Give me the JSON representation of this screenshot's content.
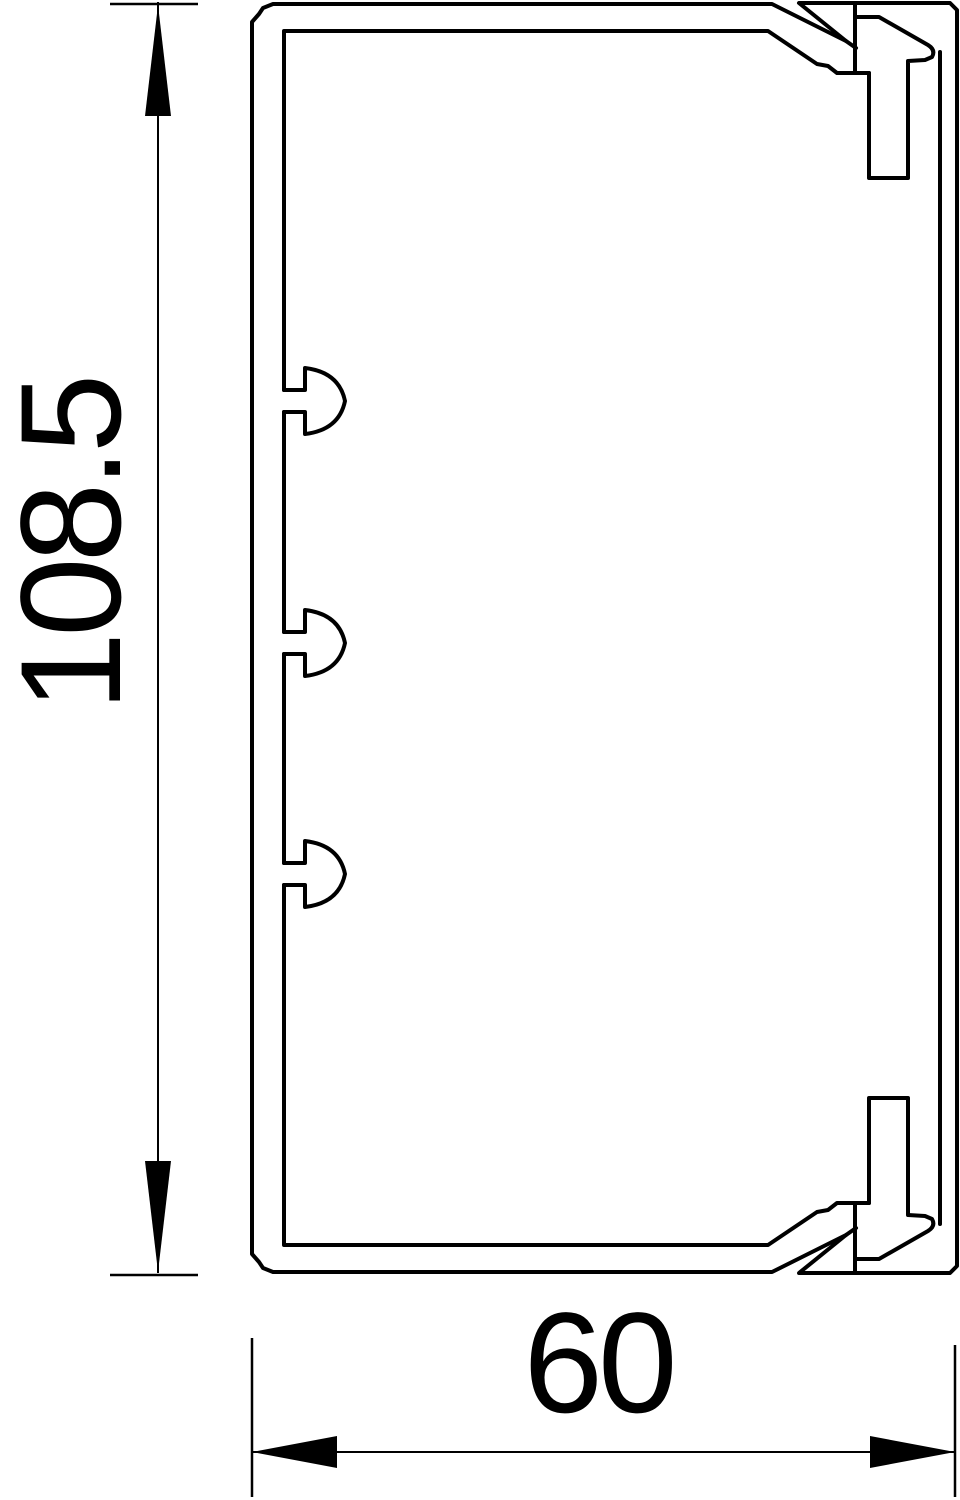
{
  "drawing": {
    "background_color": "#ffffff",
    "line_color": "#000000",
    "height_dimension": {
      "label": "108.5",
      "value": 108.5
    },
    "width_dimension": {
      "label": "60",
      "value": 60
    }
  }
}
